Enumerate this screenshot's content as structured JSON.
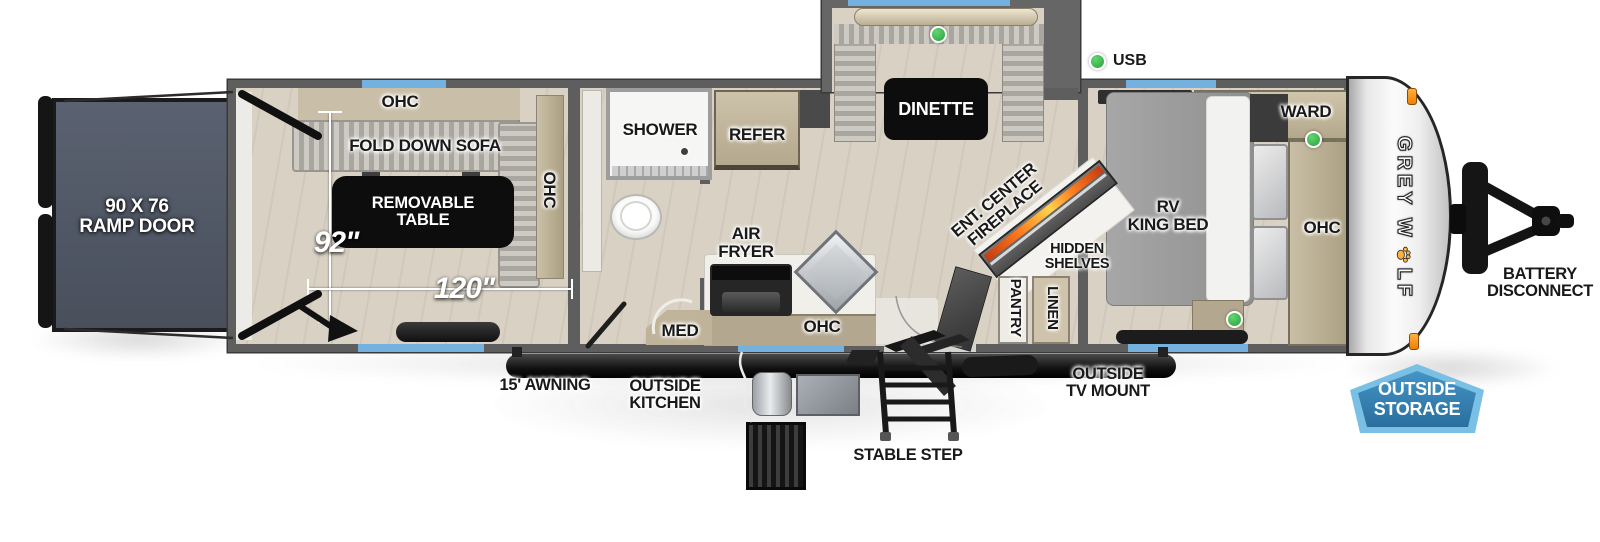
{
  "brand": {
    "name": "GREY WOLF",
    "logo_prefix": "GREY W",
    "logo_suffix": "LF"
  },
  "garage": {
    "ramp_door": "90 X 76\nRAMP DOOR",
    "ohc_top": "OHC",
    "fold_down_sofa": "FOLD DOWN SOFA",
    "removable_table": "REMOVABLE\nTABLE",
    "ohc_side": "OHC",
    "width": "92\"",
    "length": "120\""
  },
  "bathroom": {
    "shower": "SHOWER",
    "med": "MED"
  },
  "kitchen": {
    "refer": "REFER",
    "air_fryer": "AIR\nFRYER",
    "ohc": "OHC"
  },
  "dinette": {
    "label": "DINETTE",
    "usb": "USB"
  },
  "living": {
    "fireplace": "ENT. CENTER\nFIREPLACE",
    "hidden_shelves": "HIDDEN\nSHELVES",
    "pantry": "PANTRY",
    "linen": "LINEN"
  },
  "bedroom": {
    "bed": "RV\nKING BED",
    "ward": "WARD",
    "ohc": "OHC"
  },
  "exterior": {
    "battery_disconnect": "BATTERY\nDISCONNECT",
    "outside_storage": "OUTSIDE\nSTORAGE",
    "outside_tv_mount": "OUTSIDE\nTV MOUNT",
    "stable_step": "STABLE STEP",
    "awning": "15' AWNING",
    "outside_kitchen": "OUTSIDE\nKITCHEN"
  },
  "colors": {
    "window_blue": "#74b1de",
    "indicator_green": "#35a94a",
    "badge_fill": "#2f7fb3",
    "badge_border": "#74c3e6",
    "fireplace_accent": "#ff8a00",
    "clearance_light_orange": "#f59a23"
  }
}
